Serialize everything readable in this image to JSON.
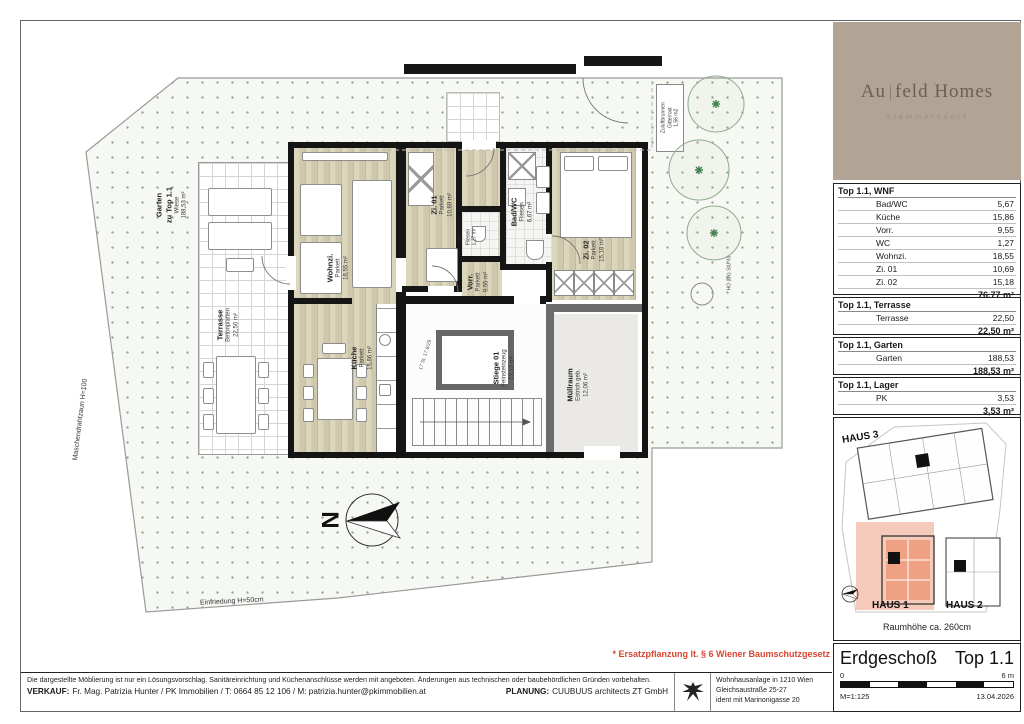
{
  "brand": {
    "part1": "Au",
    "part2": "feld Homes",
    "subtitle": "Stammersdorf"
  },
  "plan": {
    "garden": {
      "name": "Garten",
      "sub": "zu Top 1.1",
      "floor": "Wiese",
      "area": "188,53 m²"
    },
    "terrace": {
      "name": "Terrasse",
      "floor": "Betonplatten",
      "area": "22,50 m²"
    },
    "rooms": [
      {
        "name": "Wohnzi.",
        "floor": "Parkett",
        "area": "18,55 m²"
      },
      {
        "name": "Küche",
        "floor": "Parkett",
        "area": "15,86 m²"
      },
      {
        "name": "Zi. 01",
        "floor": "Parkett",
        "area": "10,69 m²"
      },
      {
        "name": "Vorr.",
        "floor": "Parkett",
        "area": "9,55 m²"
      },
      {
        "name": "WC",
        "floor": "Fliesen",
        "area": "1,27 m²"
      },
      {
        "name": "Bad/WC",
        "floor": "Fliesen",
        "area": "6,67 m²"
      },
      {
        "name": "Zi. 02",
        "floor": "Parkett",
        "area": "15,18 m²"
      },
      {
        "name": "Stiege 01",
        "floor": "Feinsteinzeug",
        "area": "13,12 m²"
      },
      {
        "name": "Müllraum",
        "floor": "Estrich geb.",
        "area": "12,06 m²"
      }
    ],
    "zuluft": {
      "l1": "Zuluftbrunnen",
      "l2": "Gitterrost",
      "l3": "1,56 m2"
    },
    "fence_bottom": "Einfriedung H=50cm",
    "fence_left": "Maschendrahtzaun H=100",
    "stair_note": "17 St. 17,6/29",
    "tree_tag": "HO (Bk) StU 45",
    "north_letter": "N",
    "note": "* Ersatzpflanzung lt. § 6 Wiener Baumschutzgesetz"
  },
  "tables": [
    {
      "title": "Top 1.1, WNF",
      "rows": [
        {
          "label": "Bad/WC",
          "value": "5,67"
        },
        {
          "label": "Küche",
          "value": "15,86"
        },
        {
          "label": "Vorr.",
          "value": "9,55"
        },
        {
          "label": "WC",
          "value": "1,27"
        },
        {
          "label": "Wohnzi.",
          "value": "18,55"
        },
        {
          "label": "Zi. 01",
          "value": "10,69"
        },
        {
          "label": "Zi. 02",
          "value": "15,18"
        }
      ],
      "total": "76,77 m²"
    },
    {
      "title": "Top 1.1, Terrasse",
      "rows": [
        {
          "label": "Terrasse",
          "value": "22,50"
        }
      ],
      "total": "22,50 m²"
    },
    {
      "title": "Top 1.1, Garten",
      "rows": [
        {
          "label": "Garten",
          "value": "188,53"
        }
      ],
      "total": "188,53 m²"
    },
    {
      "title": "Top 1.1, Lager",
      "rows": [
        {
          "label": "PK",
          "value": "3,53"
        }
      ],
      "total": "3,53 m²"
    }
  ],
  "site_plan": {
    "haus1": "HAUS 1",
    "haus2": "HAUS 2",
    "haus3": "HAUS 3",
    "room_height": "Raumhöhe ca. 260cm"
  },
  "title_block": {
    "floor": "Erdgeschoß",
    "unit": "Top 1.1",
    "scale_zero": "0",
    "scale_max": "6 m",
    "scale": "M=1:125",
    "date": "13.04.2026"
  },
  "footer": {
    "disclaimer": "Die dargestellte Möblierung ist nur ein Lösungsvorschlag. Sanitäreinrichtung und Küchenanschlüsse werden mit angeboten. Änderungen aus technischen oder baubehördlichen Gründen vorbehalten.",
    "verkauf_label": "VERKAUF:",
    "verkauf": "Fr. Mag. Patrizia Hunter / PK Immobilien / T: 0664 85 12 106 / M: patrizia.hunter@pkimmobilien.at",
    "planung_label": "PLANUNG:",
    "planung": "CUUBUUS architects ZT GmbH",
    "address_l1": "Wohnhausanlage in 1210 Wien",
    "address_l2": "Gleichsaustraße 25-27",
    "address_l3": "ident mit Marinonigasse 20"
  },
  "colors": {
    "logo_bg": "#b2a494",
    "unit_highlight": "#efa183",
    "note_red": "#d8452f",
    "parquet": "#d3ccb1"
  }
}
